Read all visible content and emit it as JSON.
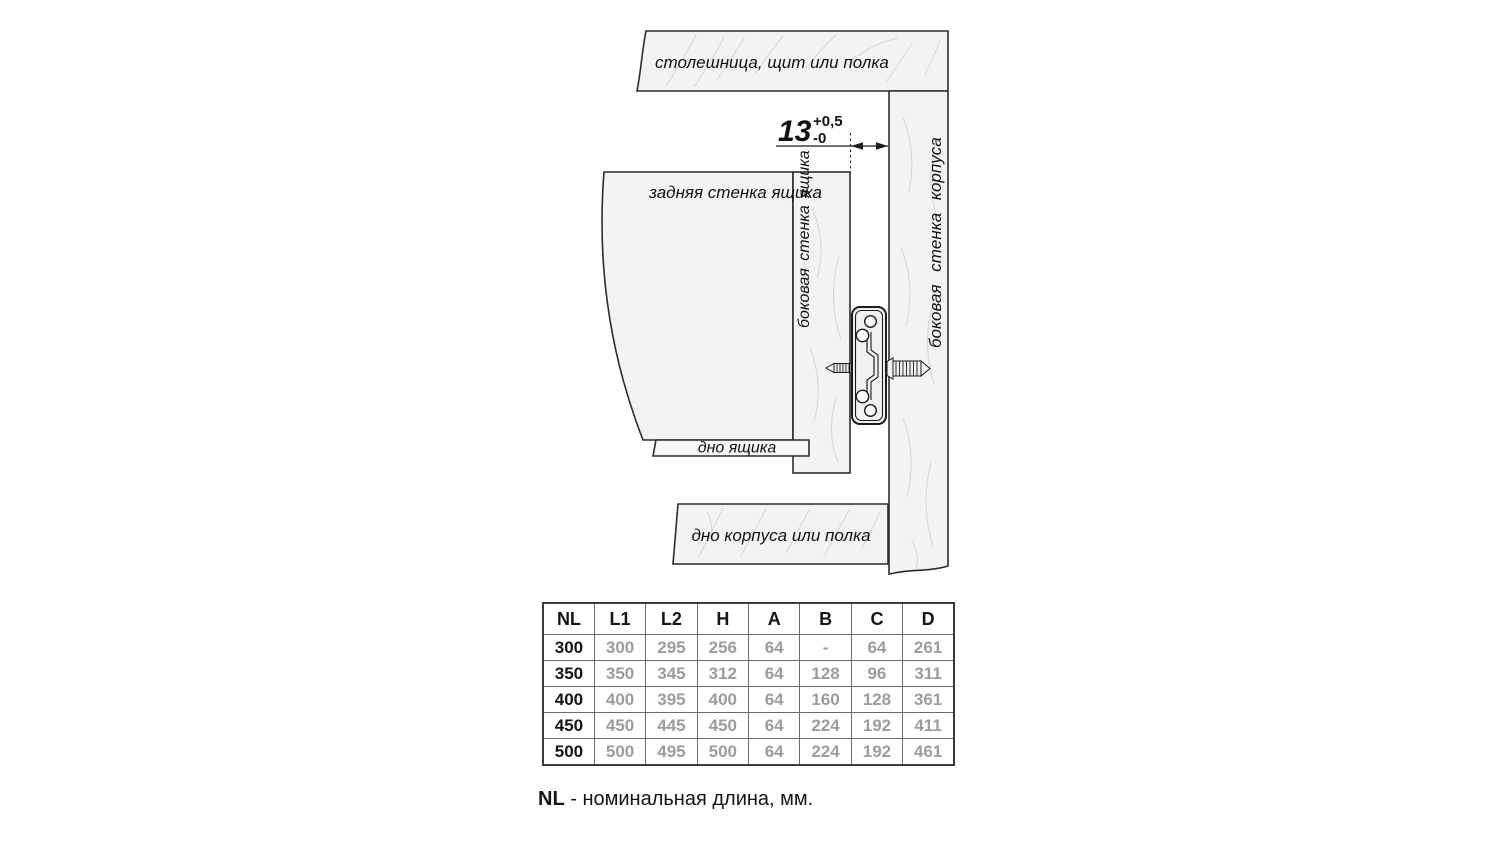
{
  "diagram": {
    "labels": {
      "top_panel": "столешница, щит или полка",
      "back_wall": "задняя стенка ящика",
      "drawer_side_wall": "боковая стенка ящика",
      "cabinet_side_wall": "боковая стенка корпуса",
      "drawer_bottom": "дно ящика",
      "cabinet_bottom": "дно корпуса или полка"
    },
    "dimension": {
      "value": "13",
      "tolerance_plus": "+0,5",
      "tolerance_minus": "-0"
    },
    "colors": {
      "panel_fill": "#f3f3f3",
      "line": "#2c2c2c",
      "grain": "#d5d5d5",
      "muted_text": "#9c9c9c"
    }
  },
  "table": {
    "columns": [
      "NL",
      "L1",
      "L2",
      "H",
      "A",
      "B",
      "C",
      "D"
    ],
    "rows": [
      [
        "300",
        "300",
        "295",
        "256",
        "64",
        "-",
        "64",
        "261"
      ],
      [
        "350",
        "350",
        "345",
        "312",
        "64",
        "128",
        "96",
        "311"
      ],
      [
        "400",
        "400",
        "395",
        "400",
        "64",
        "160",
        "128",
        "361"
      ],
      [
        "450",
        "450",
        "445",
        "450",
        "64",
        "224",
        "192",
        "411"
      ],
      [
        "500",
        "500",
        "495",
        "500",
        "64",
        "224",
        "192",
        "461"
      ]
    ]
  },
  "caption": {
    "term": "NL",
    "text": " - номинальная длина, мм."
  }
}
